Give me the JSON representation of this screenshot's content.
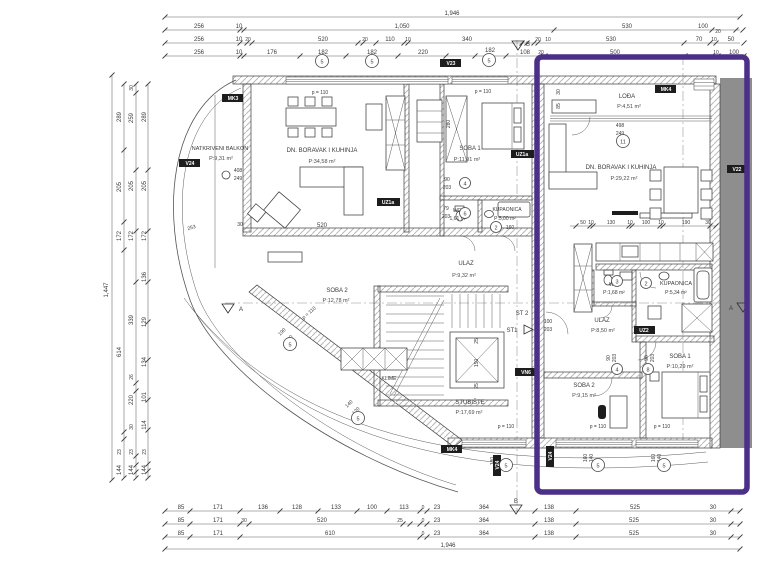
{
  "colors": {
    "highlight": "#4c2f87",
    "neighbor_band": "#8e8e8e"
  },
  "rooms": {
    "balkon": {
      "name": "NATKRIVENI BALKON",
      "area": "P:9,31 m²"
    },
    "living_left": {
      "name": "DN. BORAVAK I KUHINJA",
      "area": "P:34,58 m²"
    },
    "soba1_left": {
      "name": "SOBA 1",
      "area": "P:11,91 m²"
    },
    "wc_left": {
      "name": "WC",
      "area": "1,61 m²"
    },
    "kupaonica_left": {
      "name": "KUPAONICA",
      "area": "P:5,00 m²"
    },
    "ulaz_left": {
      "name": "ULAZ",
      "area": "P:9,32 m²"
    },
    "soba2_left": {
      "name": "SOBA 2",
      "area": "P:12,78 m²"
    },
    "stubiste": {
      "name": "STUBIŠTE",
      "area": "P:17,69 m²"
    },
    "klime": {
      "name": "KLIME"
    },
    "lodja": {
      "name": "LOĐA",
      "area": "P:4,51 m²"
    },
    "living_right": {
      "name": "DN. BORAVAK I KUHINJA",
      "area": "P:29,22 m²"
    },
    "wc_right": {
      "name": "WC",
      "area": "P:1,68 m²"
    },
    "kupaonica_right": {
      "name": "KUPAONICA",
      "area": "P:5,34 m²"
    },
    "ulaz_right": {
      "name": "ULAZ",
      "area": "P:8,50 m²"
    },
    "soba1_right": {
      "name": "SOBA 1",
      "area": "P:10,29 m²"
    },
    "soba2_right": {
      "name": "SOBA 2",
      "area": "P:9,15 m²"
    }
  },
  "tags": {
    "v24": "V24",
    "mk3": "MK3",
    "v23": "V23",
    "mk4": "MK4",
    "uz1a": "UZ1a",
    "uz2": "UZ2",
    "v22": "V22",
    "vn6": "VN6"
  },
  "markers": {
    "a": "A",
    "b": "B",
    "st1": "ST1",
    "st2": "ST 2"
  },
  "circles": {
    "n2": "2",
    "n3": "3",
    "n4": "4",
    "n5": "5",
    "n6": "6",
    "n8": "8",
    "n11": "11"
  },
  "notes": {
    "p110": "p = 110"
  },
  "dims": {
    "top_total": "1,946",
    "t2": [
      "256",
      "10",
      "1,050",
      "530",
      "100",
      "20"
    ],
    "t3": [
      "256",
      "10",
      "20",
      "520",
      "20",
      "110",
      "10",
      "340",
      "20",
      "10",
      "530",
      "70",
      "10",
      "50"
    ],
    "t4": [
      "256",
      "10",
      "176",
      "182",
      "182",
      "220",
      "182",
      "108",
      "20",
      "500",
      "10",
      "100"
    ],
    "left_total": "1,447",
    "l1": [
      "289",
      "205",
      "172",
      "614",
      "23",
      "144"
    ],
    "l2": [
      "30",
      "259",
      "205",
      "172",
      "339",
      "26",
      "220",
      "30",
      "23",
      "144"
    ],
    "l3": [
      "289",
      "205",
      "172",
      "136",
      "129",
      "134",
      "101",
      "114",
      "23",
      "144"
    ],
    "b1": [
      "85",
      "171",
      "136",
      "128",
      "133",
      "100",
      "113",
      "0",
      "23",
      "364",
      "138",
      "525",
      "30"
    ],
    "b2": [
      "85",
      "171",
      "30",
      "520",
      "25",
      "0",
      "23",
      "364",
      "138",
      "525",
      "30"
    ],
    "b3": [
      "85",
      "171",
      "610",
      "0",
      "23",
      "364",
      "138",
      "525",
      "30"
    ],
    "bottom_total": "1,946",
    "kitchen_row": [
      "50",
      "10",
      "130",
      "10",
      "100",
      "10",
      "190",
      "30"
    ],
    "inner": {
      "w30": "30",
      "w520": "520",
      "s408": "408",
      "s249": "249",
      "s498": "498",
      "s249b": "249",
      "h280": "280",
      "d90": "90",
      "d203": "203",
      "d79": "79",
      "d203b": "203",
      "d160": "160",
      "d100": "100",
      "d203c": "203",
      "v30": "30",
      "v85": "85",
      "e25a": "25",
      "e150": "150",
      "e25b": "25",
      "g190": "190",
      "g140": "140",
      "g140b": "140",
      "g120": "120",
      "b180": "180",
      "b140": "140",
      "b160": "160",
      "b140b": "140",
      "b160b": "160",
      "b140c": "140",
      "r90": "90",
      "r203": "203",
      "r90b": "90",
      "r203b": "203",
      "arc253": "253"
    }
  }
}
